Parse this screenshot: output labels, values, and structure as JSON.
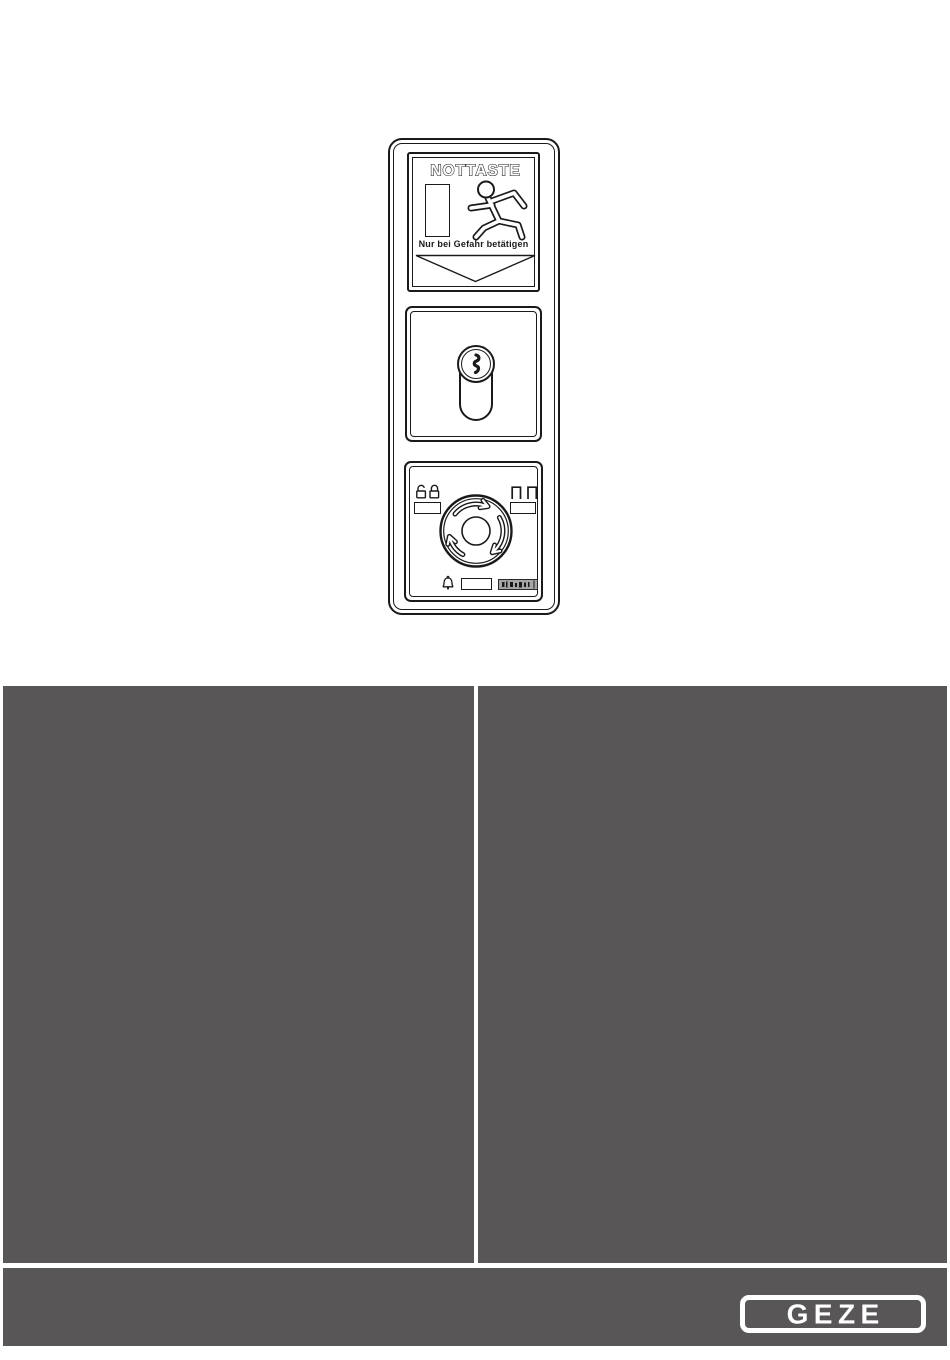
{
  "document": {
    "type": "manual-cover-page",
    "background": "#ffffff"
  },
  "device_illustration": {
    "emergency_button_module": {
      "title": "NOTTASTE",
      "warning_text": "Nur bei Gefahr betätigen",
      "icons": [
        "door-icon",
        "running-person-icon",
        "down-arrow-icon"
      ]
    },
    "key_switch_module": {
      "icons": [
        "key-cylinder-icon",
        "keyhole-icon"
      ]
    },
    "rotary_control_module": {
      "icons": [
        "unlock-padlock-icon",
        "locked-padlock-icon",
        "door-symbols-icon",
        "rotation-arrows-icon",
        "bell-icon"
      ],
      "indicators": [
        "left-indicator-window",
        "right-indicator-window",
        "button-window",
        "label-plate"
      ]
    }
  },
  "content_panel": {
    "background": "#585657",
    "divider_color": "#ffffff",
    "left_column_text": "",
    "right_column_text": ""
  },
  "footer": {
    "background": "#585657",
    "logo_text": "GEZE",
    "logo_color": "#ffffff"
  }
}
